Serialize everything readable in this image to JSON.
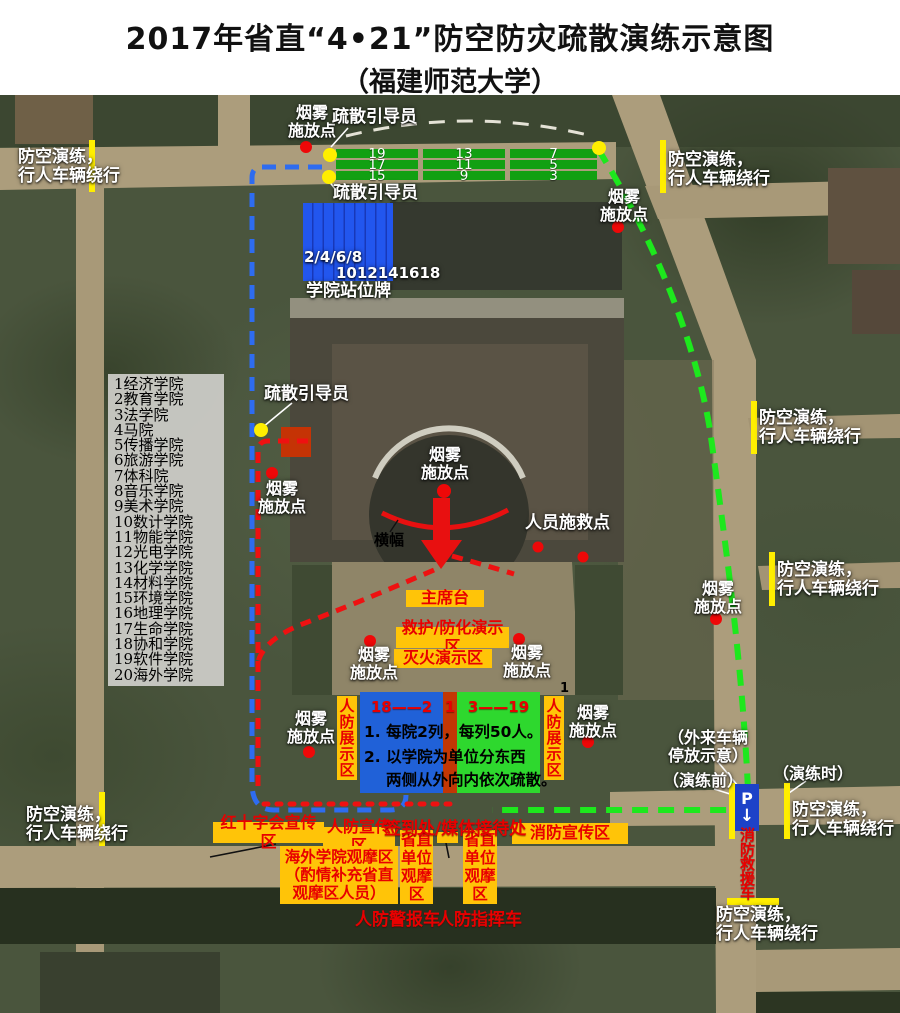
{
  "title": {
    "line1": "2017年省直“4•21”防空防灾疏散演练示意图",
    "line2": "（福建师范大学）"
  },
  "map": {
    "college_list": [
      "1经济学院",
      "2教育学院",
      "3法学院",
      "4马院",
      "5传播学院",
      "6旅游学院",
      "7体科院",
      "8音乐学院",
      "9美术学院",
      "10数计学院",
      "11物能学院",
      "12光电学院",
      "13化学学院",
      "14材料学院",
      "15环境学院",
      "16地理学院",
      "17生命学院",
      "18协和学院",
      "19软件学院",
      "20海外学院"
    ],
    "labels": {
      "detour": "防空演练，\n行人车辆绕行",
      "smoke": "烟雾\n施放点",
      "guide": "疏散引导员",
      "rescue_point": "人员施救点",
      "banner": "横幅",
      "station_sign": "学院站位牌",
      "checkin": "签到处/媒体接待处",
      "stray_index": "1"
    },
    "station_rows": {
      "green_groups": [
        [
          "19",
          "17",
          "15"
        ],
        [
          "13",
          "11",
          "9"
        ],
        [
          "7",
          "5",
          "3"
        ]
      ],
      "blue_line1": "2/4/6/8",
      "blue_line2": "1012141618"
    },
    "zones": {
      "stage": "主席台",
      "aid_demo": "救护/防化演示区",
      "fire_demo": "灭火演示区",
      "cd_display": "人防展示区",
      "red_cross_promo": "红十字会宣传区",
      "cd_promo": "人防宣传区",
      "fire_promo": "消防宣传区",
      "overseas_viewing": "海外学院观摩区\n（酌情补充省直\n观摩区人员）",
      "provincial_viewing": "省直单位观摩区"
    },
    "formation": {
      "west_range": "18——2",
      "center_index": "1",
      "east_range": "3——19",
      "note1": "1. 每院2列，每列50人。",
      "note2": "2. 以学院为单位分东西",
      "note3": "两侧从外向内依次疏散。"
    },
    "vehicles": {
      "alarm": "人防警报车",
      "command": "人防指挥车",
      "fire_rescue": "消防救援车"
    },
    "parking": {
      "p": "P",
      "arrow": "↓",
      "outside": "（外来车辆\n停放示意）",
      "before": "（演练前）",
      "during": "（演练时）"
    }
  },
  "colors": {
    "route_west_blue": "#2e6cf0",
    "route_red": "#ee1111",
    "route_east_green": "#1de81d",
    "zone_yellow": "#ffc408",
    "zone_text_red": "#e80000",
    "station_green": "#12a012",
    "station_blue": "#2256ee",
    "formation_blue": "#2061d8",
    "formation_green": "#2ed82e",
    "formation_strip": "#c23705",
    "marker_red": "#ee0808",
    "marker_yellow": "#ffee00",
    "parking_blue": "#1d42c8",
    "road_tan": "#ac9d7c"
  }
}
